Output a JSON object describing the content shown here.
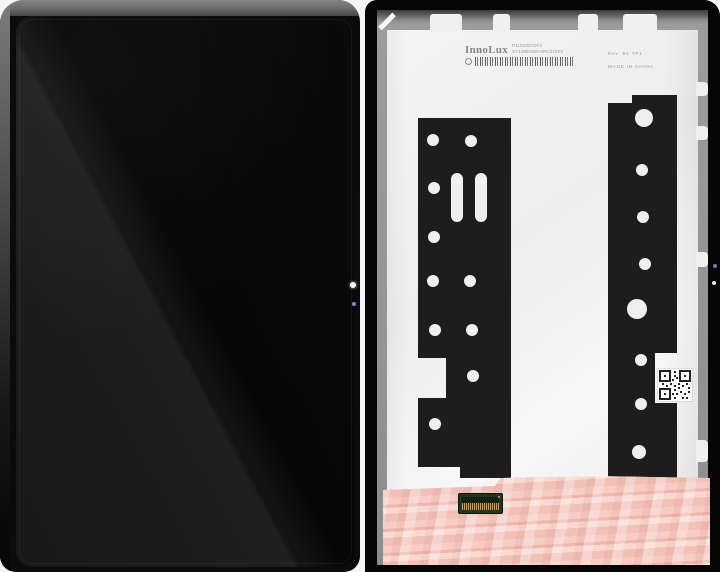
{
  "product_label": {
    "brand": "InnoLux",
    "model_line": "P110ZZD-DF2",
    "serial_line": "SY1068XW0-0RC21023",
    "rev_line": "Rev. B1  TP1",
    "origin_line": "MADE IN CHINA"
  },
  "colors": {
    "background": "#f5f5f5",
    "frame_gray": "#7a7a7a",
    "screen_black": "#0d0d0d",
    "panel_black": "#060606",
    "plate_silver": "#f1f1f1",
    "adhesive_black": "#1d1d1d",
    "tape_pink": "#f3c2b9",
    "connector_green": "#22351e",
    "connector_pins_gold": "#c99a52",
    "camera_dot": "#f4f4f4",
    "sensor_dot": "#8d83c8"
  }
}
